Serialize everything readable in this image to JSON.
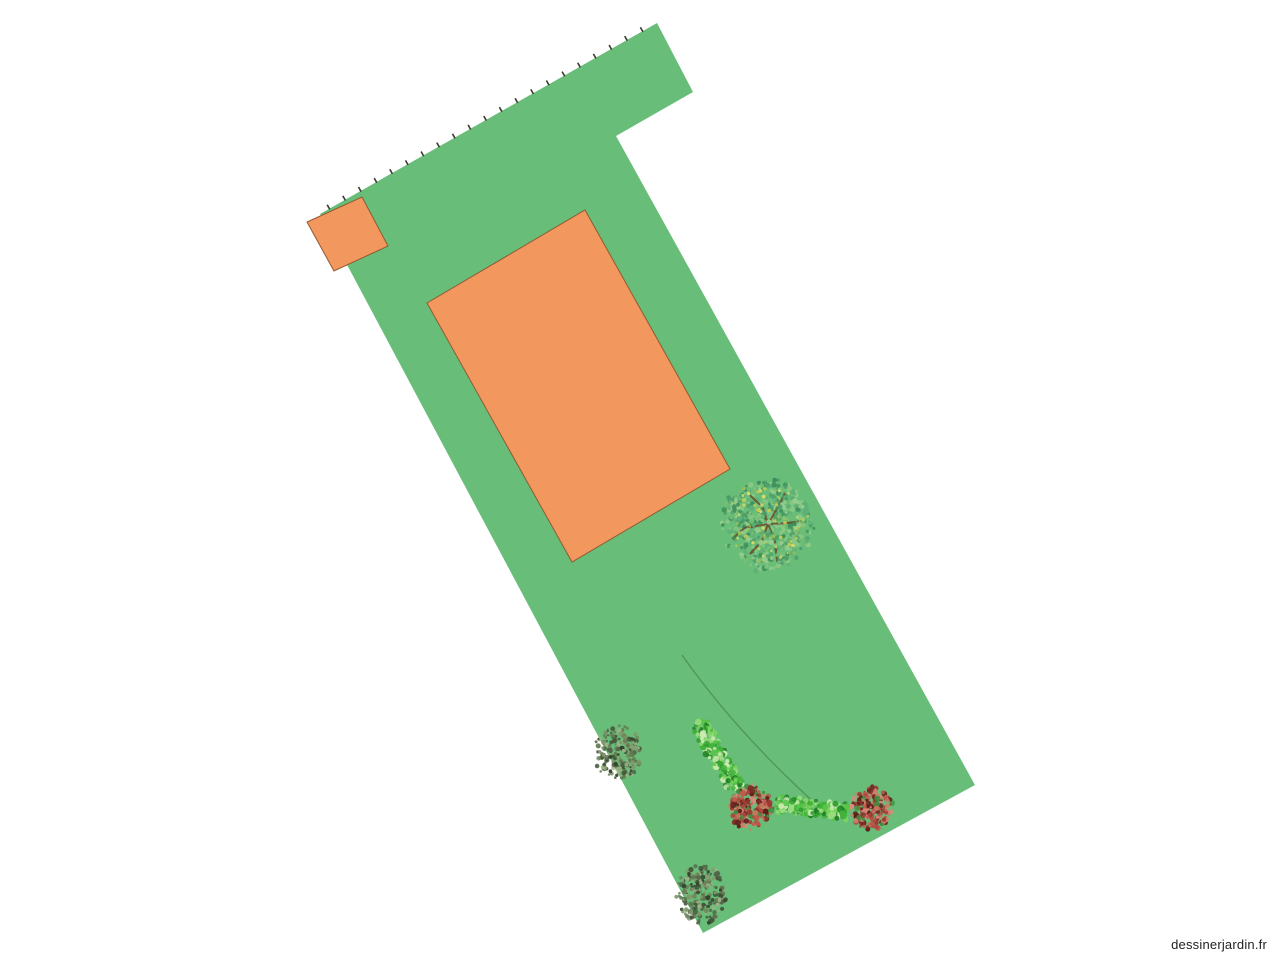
{
  "watermark": {
    "text": "dessinerjardin.fr",
    "color": "#222222"
  },
  "plan": {
    "background": "#ffffff",
    "parcel": {
      "label": "lawn-parcel",
      "fill": "#68BD79",
      "vertices": [
        [
          320,
          214
        ],
        [
          657,
          23
        ],
        [
          693,
          92
        ],
        [
          616,
          136
        ],
        [
          975,
          785
        ],
        [
          703,
          933
        ]
      ],
      "fence": {
        "from": [
          320,
          214
        ],
        "to": [
          657,
          23
        ],
        "spacing": 18,
        "tick_length": 4.5,
        "color": "#3B3B2B"
      }
    },
    "buildings": [
      {
        "label": "annex",
        "fill": "#F2975D",
        "stroke": "#8F5B33",
        "vertices": [
          [
            362,
            197
          ],
          [
            388,
            246
          ],
          [
            334,
            271
          ],
          [
            307,
            222
          ]
        ]
      },
      {
        "label": "house",
        "fill": "#F2975D",
        "stroke": "#8F5B33",
        "vertices": [
          [
            585,
            210
          ],
          [
            730,
            469
          ],
          [
            572,
            562
          ],
          [
            427,
            303
          ]
        ]
      }
    ],
    "path_curve": {
      "d": "M 682 655 Q 737 733 818 806",
      "color": "rgba(55,105,65,0.5)",
      "width": 1.3
    },
    "plants": {
      "tree": {
        "cx": 768,
        "cy": 524,
        "r": 45,
        "seed": 7,
        "foliage": [
          "#4E9E6C",
          "#5FB078",
          "#73BE74",
          "#88C883",
          "#3E8F5B",
          "#97CD8C"
        ],
        "accents": [
          "#C4CE55",
          "#D8DC66",
          "#9FBE4F"
        ],
        "branch_color": "#6D4B2A"
      },
      "hedge_palette": [
        "#2E9E30",
        "#41B33A",
        "#58C548",
        "#79D45F",
        "#1E7E22",
        "#99DB7E",
        "#CFEBB4"
      ],
      "hedges": [
        {
          "x1": 698,
          "y1": 722,
          "x2": 737,
          "y2": 789,
          "width": 17,
          "seed": 11
        },
        {
          "x1": 776,
          "y1": 804,
          "x2": 847,
          "y2": 812,
          "width": 16,
          "seed": 12
        }
      ],
      "flower_palette": [
        "#B04A40",
        "#C05B4D",
        "#9A3931",
        "#7C2A25",
        "#D88B7B",
        "#5E1D1A",
        "#C97F63",
        "#3E8F3E"
      ],
      "flower_bushes": [
        {
          "cx": 751,
          "cy": 808,
          "r": 22,
          "seed": 21
        },
        {
          "cx": 871,
          "cy": 808,
          "r": 21,
          "seed": 22
        }
      ],
      "shrub_palette": [
        "#53664A",
        "#46593C",
        "#62784F",
        "#81996B",
        "#354430",
        "#9DB388",
        "#6E8259"
      ],
      "shrubs": [
        {
          "cx": 618,
          "cy": 752,
          "rx": 23,
          "ry": 27,
          "seed": 31
        },
        {
          "cx": 702,
          "cy": 894,
          "rx": 25,
          "ry": 29,
          "seed": 32
        }
      ]
    }
  }
}
